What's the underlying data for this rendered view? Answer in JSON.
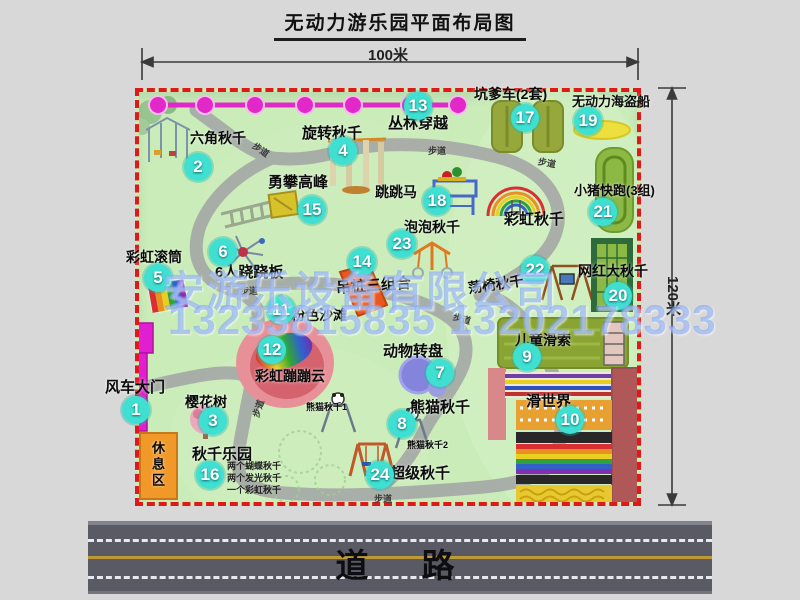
{
  "title": "无动力游乐园平面布局图",
  "dimensions": {
    "width_label": "100米",
    "height_label": "120米"
  },
  "road_label": "道　路",
  "watermark": {
    "company": "安游乐设备有限公司",
    "phone": "13233815835 13202178333"
  },
  "colors": {
    "badge": "#3fe0d2",
    "map_border": "#e01818",
    "park_green": "#c9ecb9",
    "road_gray": "#5a5a64",
    "jungle_line_magenta": "#e228c8",
    "gate_magenta": "#e020d0",
    "rest_area_orange": "#f09828"
  },
  "attractions": [
    {
      "num": "1",
      "name": "风车大门",
      "badge": {
        "x": 136,
        "y": 410
      },
      "label": {
        "x": 105,
        "y": 376,
        "size": 15
      }
    },
    {
      "num": "2",
      "name": "六角秋千",
      "badge": {
        "x": 198,
        "y": 167
      },
      "label": {
        "x": 190,
        "y": 128,
        "size": 14
      }
    },
    {
      "num": "3",
      "name": "樱花树",
      "badge": {
        "x": 213,
        "y": 421
      },
      "label": {
        "x": 185,
        "y": 392,
        "size": 14
      }
    },
    {
      "num": "4",
      "name": "旋转秋千",
      "badge": {
        "x": 343,
        "y": 151
      },
      "label": {
        "x": 302,
        "y": 122,
        "size": 15
      }
    },
    {
      "num": "5",
      "name": "彩虹滚筒",
      "badge": {
        "x": 158,
        "y": 278
      },
      "label": {
        "x": 126,
        "y": 247,
        "size": 14
      }
    },
    {
      "num": "6",
      "name": "6人跷跷板",
      "badge": {
        "x": 223,
        "y": 252
      },
      "label": {
        "x": 215,
        "y": 261,
        "size": 15
      }
    },
    {
      "num": "7",
      "name": "动物转盘",
      "badge": {
        "x": 440,
        "y": 373
      },
      "label": {
        "x": 383,
        "y": 340,
        "size": 15
      }
    },
    {
      "num": "8",
      "name": "熊猫秋千",
      "badge": {
        "x": 402,
        "y": 424
      },
      "label": {
        "x": 410,
        "y": 396,
        "size": 15
      }
    },
    {
      "num": "9",
      "name": "儿童滑索",
      "badge": {
        "x": 527,
        "y": 357
      },
      "label": {
        "x": 515,
        "y": 330,
        "size": 14
      }
    },
    {
      "num": "10",
      "name": "滑世界",
      "badge": {
        "x": 570,
        "y": 420
      },
      "label": {
        "x": 526,
        "y": 390,
        "size": 15
      }
    },
    {
      "num": "11",
      "name": "粉色沙滩",
      "badge": {
        "x": 281,
        "y": 310
      },
      "label": {
        "x": 291,
        "y": 305,
        "size": 14
      }
    },
    {
      "num": "12",
      "name": "彩虹蹦蹦云",
      "badge": {
        "x": 272,
        "y": 350
      },
      "label": {
        "x": 255,
        "y": 366,
        "size": 14
      }
    },
    {
      "num": "13",
      "name": "丛林穿越",
      "badge": {
        "x": 418,
        "y": 106
      },
      "label": {
        "x": 388,
        "y": 112,
        "size": 15
      }
    },
    {
      "num": "14",
      "name": "吊桩三组合",
      "badge": {
        "x": 362,
        "y": 262
      },
      "label": {
        "x": 336,
        "y": 277,
        "size": 15,
        "rot": -4
      }
    },
    {
      "num": "15",
      "name": "勇攀高峰",
      "badge": {
        "x": 312,
        "y": 210
      },
      "label": {
        "x": 268,
        "y": 171,
        "size": 15
      }
    },
    {
      "num": "16",
      "name": "秋千乐园",
      "badge": {
        "x": 210,
        "y": 475
      },
      "label": {
        "x": 192,
        "y": 443,
        "size": 15
      }
    },
    {
      "num": "17",
      "name": "坑爹车(2套)",
      "badge": {
        "x": 525,
        "y": 118
      },
      "label": {
        "x": 474,
        "y": 84,
        "size": 14
      }
    },
    {
      "num": "18",
      "name": "跳跳马",
      "badge": {
        "x": 437,
        "y": 201
      },
      "label": {
        "x": 375,
        "y": 182,
        "size": 14
      }
    },
    {
      "num": "19",
      "name": "无动力海盗船",
      "badge": {
        "x": 588,
        "y": 121
      },
      "label": {
        "x": 572,
        "y": 91,
        "size": 13
      }
    },
    {
      "num": "20",
      "name": "网红大秋千",
      "badge": {
        "x": 618,
        "y": 296
      },
      "label": {
        "x": 578,
        "y": 261,
        "size": 14
      }
    },
    {
      "num": "21",
      "name": "小猪快跑(3组)",
      "badge": {
        "x": 603,
        "y": 212
      },
      "label": {
        "x": 574,
        "y": 180,
        "size": 13
      }
    },
    {
      "num": "22",
      "name": "荡椅秋千",
      "badge": {
        "x": 535,
        "y": 270
      },
      "label": {
        "x": 468,
        "y": 278,
        "size": 14,
        "rot": -8
      }
    },
    {
      "num": "23",
      "name": "泡泡秋千",
      "badge": {
        "x": 402,
        "y": 244
      },
      "label": {
        "x": 404,
        "y": 217,
        "size": 14
      }
    },
    {
      "num": "24",
      "name": "超级秋千",
      "badge": {
        "x": 380,
        "y": 475
      },
      "label": {
        "x": 390,
        "y": 462,
        "size": 15
      }
    }
  ],
  "extra_labels": [
    {
      "text": "彩虹秋千",
      "x": 504,
      "y": 208,
      "size": 15
    },
    {
      "text": "熊猫秋千1",
      "x": 306,
      "y": 400,
      "size": 9
    },
    {
      "text": "熊猫秋千2",
      "x": 407,
      "y": 438,
      "size": 9
    },
    {
      "text": "休息区",
      "x": 148,
      "y": 441,
      "size": 13,
      "vertical": true
    }
  ],
  "swing_park_notes": [
    "两个蝴蝶秋千",
    "两个发光秋千",
    "一个彩虹秋千"
  ],
  "path_labels": [
    {
      "text": "步道",
      "x": 252,
      "y": 143,
      "rot": 35
    },
    {
      "text": "步道",
      "x": 428,
      "y": 144,
      "rot": 0
    },
    {
      "text": "步道",
      "x": 538,
      "y": 156,
      "rot": 10
    },
    {
      "text": "步道",
      "x": 240,
      "y": 284,
      "rot": 0
    },
    {
      "text": "步道",
      "x": 249,
      "y": 402,
      "rot": -72
    },
    {
      "text": "步道",
      "x": 374,
      "y": 492,
      "rot": 0
    },
    {
      "text": "步道",
      "x": 453,
      "y": 312,
      "rot": 15
    }
  ]
}
